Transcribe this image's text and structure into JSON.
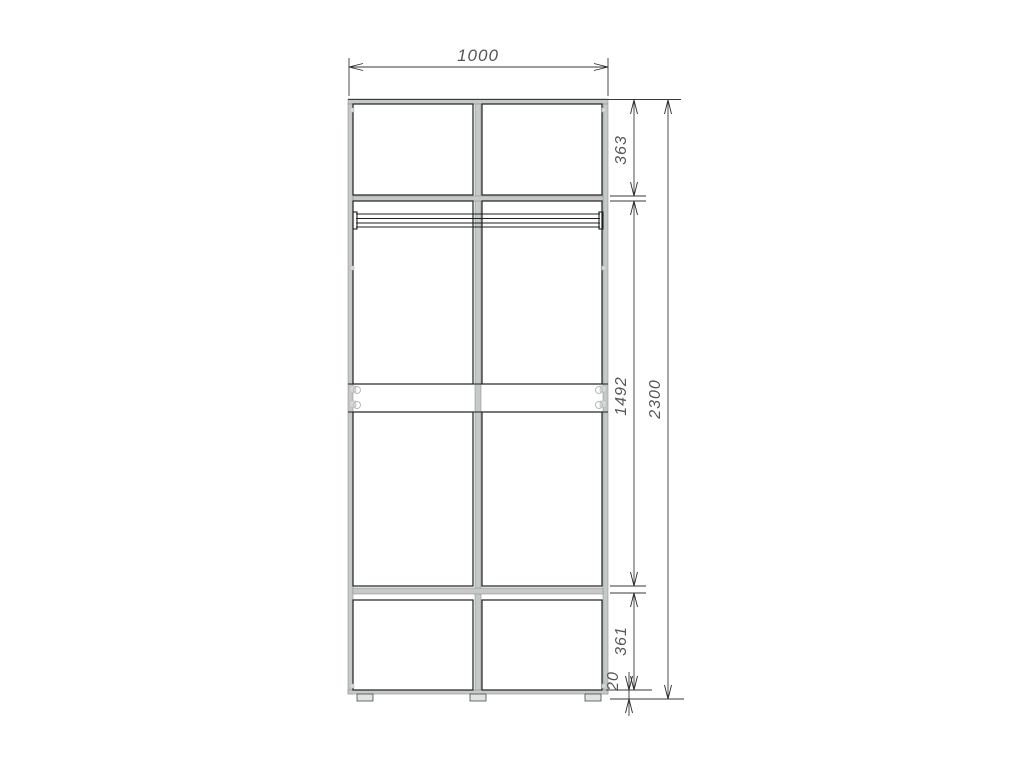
{
  "colors": {
    "line": "#1f1f1f",
    "dimension_line": "#3a3a3a",
    "text": "#565656",
    "carcass_gray": "#c6c9c9",
    "background": "#ffffff"
  },
  "dimensions": {
    "overall_width": "1000",
    "overall_height": "2300",
    "top_section_height": "363",
    "middle_section_height": "1492",
    "bottom_section_height": "361",
    "plinth_height": "20"
  }
}
